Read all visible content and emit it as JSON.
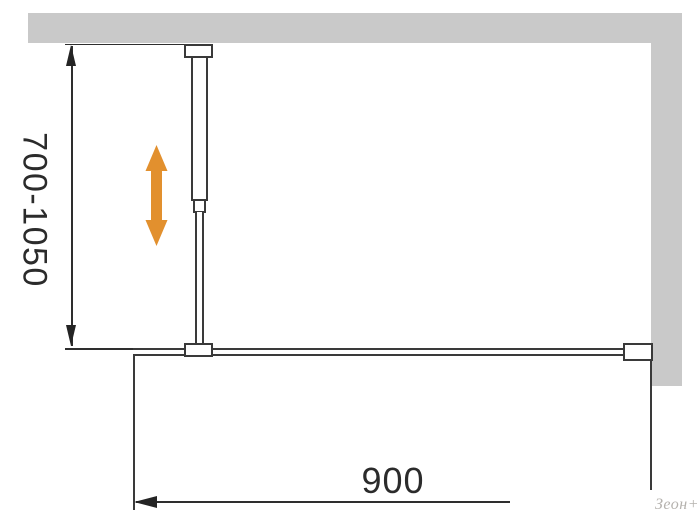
{
  "diagram": {
    "vertical_dimension": {
      "label": "700-1050"
    },
    "horizontal_dimension": {
      "label": "900"
    },
    "watermark": "Зеон+",
    "icons": {
      "height_adjust": "double-vertical-arrow-icon"
    },
    "colors": {
      "wall_gray": "#c9c9c9",
      "line_dark": "#3a3a3a",
      "dimension_dark": "#2e2e2e",
      "adjust_arrow_orange": "#e2902e",
      "watermark_gray": "#b5b2ae",
      "background": "#ffffff"
    }
  }
}
